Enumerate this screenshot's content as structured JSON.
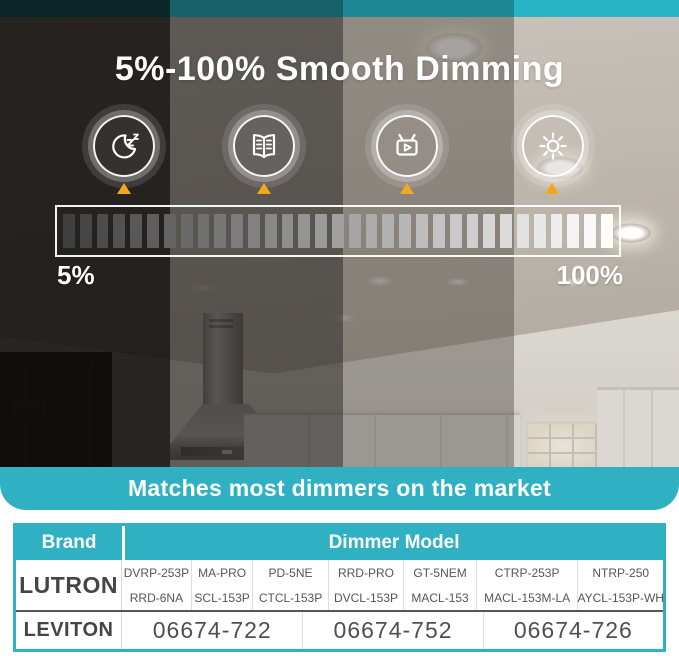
{
  "hero": {
    "title": "5%-100% Smooth Dimming",
    "min_label": "5%",
    "max_label": "100%",
    "segment_count": 33,
    "scenes": [
      {
        "name": "night-sleep",
        "icon": "moon-zz-icon"
      },
      {
        "name": "reading",
        "icon": "open-book-icon"
      },
      {
        "name": "tv-watching",
        "icon": "tv-play-icon"
      },
      {
        "name": "full-brightness",
        "icon": "sun-icon"
      }
    ]
  },
  "banner": {
    "text": "Matches most dimmers on the market"
  },
  "compatibility_table": {
    "brand_header": "Brand",
    "model_header": "Dimmer Model",
    "lutron": {
      "brand": "LUTRON",
      "models_row1": [
        "DVRP-253P",
        "MA-PRO",
        "PD-5NE",
        "RRD-PRO",
        "GT-5NEM",
        "CTRP-253P",
        "NTRP-250"
      ],
      "models_row2": [
        "RRD-6NA",
        "SCL-153P",
        "CTCL-153P",
        "DVCL-153P",
        "MACL-153",
        "MACL-153M-LA",
        "AYCL-153P-WH"
      ]
    },
    "leviton": {
      "brand": "LEVITON",
      "models": [
        "06674-722",
        "06674-752",
        "06674-726"
      ]
    }
  },
  "colors": {
    "accent_teal": "#2fb1c3",
    "triangle_orange": "#f3a71e",
    "strip_shades": [
      "#0d2629",
      "#16606a",
      "#1e8795",
      "#2ab5c6"
    ],
    "segment_dark": "#404040",
    "segment_bright": "#ffffff"
  }
}
